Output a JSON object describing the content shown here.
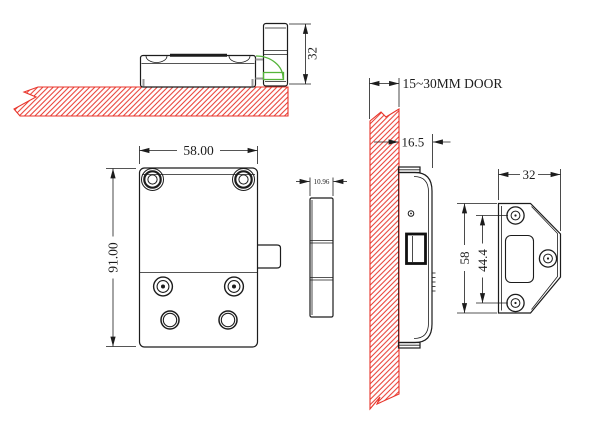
{
  "meta": {
    "description": "Technical installation drawing of a cabinet lock with strike plate",
    "line_color": "#1c1c1c",
    "hatch_color": "#e8352b",
    "highlight_color": "#55b43a",
    "background": "#ffffff"
  },
  "views": {
    "side_mounted": {
      "dims": {
        "plate_height": "32"
      }
    },
    "lock_front": {
      "dims": {
        "width": "58.00",
        "height": "91.00"
      }
    },
    "lock_edge": {
      "dims": {
        "thickness": "10.96"
      }
    },
    "door_section": {
      "dims": {
        "door_thickness": "15~30MM DOOR",
        "mount_depth": "16.5"
      }
    },
    "strike_plate": {
      "dims": {
        "width": "32",
        "height": "58",
        "hole_spacing": "44.4"
      }
    }
  }
}
